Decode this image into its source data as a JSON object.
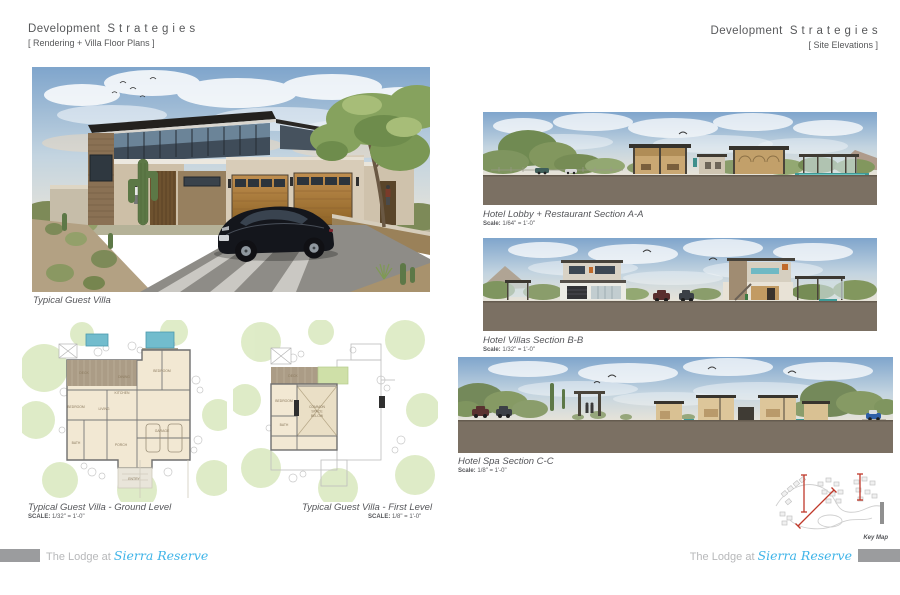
{
  "page_left": {
    "title": "Development  S t r a t e g i e s",
    "subtitle": "[ Rendering + Villa Floor Plans ]",
    "rendering_caption": "Typical Guest Villa",
    "plans": [
      {
        "caption": "Typical Guest Villa - Ground Level",
        "scale_label": "SCALE:",
        "scale_value": "1/32\" = 1'-0\"",
        "room_labels": [
          "DECK",
          "DINING",
          "KITCHEN",
          "LIVING",
          "BEDROOM",
          "BEDROOM",
          "BATH",
          "PORCH",
          "GARAGE",
          "ENTRY"
        ]
      },
      {
        "caption": "Typical Guest Villa - First Level",
        "scale_label": "SCALE:",
        "scale_value": "1/8\" = 1'-0\"",
        "room_labels": [
          "DECK",
          "BEDROOM",
          "BATH",
          "COMMON",
          "SPACE",
          "BELOW"
        ]
      }
    ]
  },
  "page_right": {
    "title": "Development  S t r a t e g i e s",
    "subtitle": "[ Site Elevations ]",
    "elevations": [
      {
        "caption": "Hotel Lobby + Restaurant Section A-A",
        "scale_label": "Scale:",
        "scale_value": "1/64\" = 1'-0\""
      },
      {
        "caption": "Hotel Villas Section B-B",
        "scale_label": "Scale:",
        "scale_value": "1/32\" = 1'-0\""
      },
      {
        "caption": "Hotel Spa Section C-C",
        "scale_label": "Scale:",
        "scale_value": "1/8\" = 1'-0\""
      }
    ],
    "key_map_label": "Key Map"
  },
  "footer": {
    "prefix": "The Lodge at",
    "brand": "Sierra Reserve"
  },
  "colors": {
    "brand_blue": "#3fb4e8",
    "ground_taupe": "#7b7063",
    "keymap_red": "#c0392b",
    "footer_gray": "#9b9c9e",
    "heading_gray": "#57585a"
  }
}
